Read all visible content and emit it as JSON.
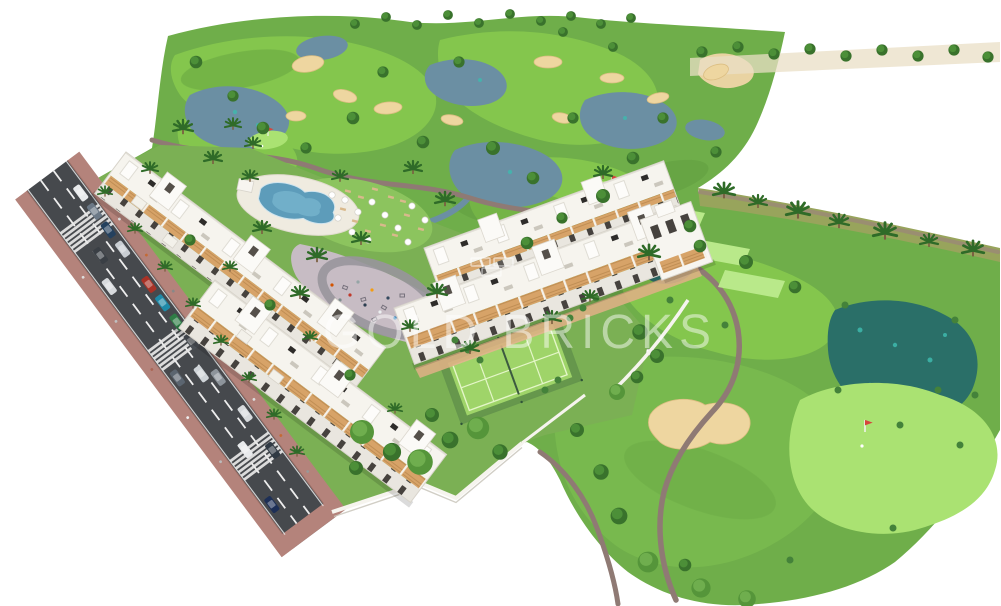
{
  "scene": {
    "type": "architectural-aerial-render",
    "description": "Aerial 3D rendering of a white low-rise apartment resort beside a golf course with lakes, sand bunkers, a lagoon swimming pool, padel court, playground plaza, walled gardens and a tree-lined street with traffic",
    "watermark": {
      "text": "GOLD BRICKS"
    }
  },
  "palette": {
    "background": "#ffffff",
    "golf_base_green": "#6fae4a",
    "fairway_green": "#84c64d",
    "putting_green": "#aae272",
    "tee_green": "#b9e98a",
    "site_lawn_green": "#7bb054",
    "lake_blue": "#6b8fa3",
    "wetland_teal": "#2a6f68",
    "pool_blue": "#5d9cba",
    "sand_bunker": "#eed6a0",
    "cart_path_brown": "#8f7a74",
    "asphalt_gray": "#46494d",
    "sidewalk_brick": "#b4837b",
    "building_white": "#f7f5f0",
    "terrace_wood": "#d7a368",
    "padel_court_green": "#9fd469",
    "plaza_paving": "#c7bcc4",
    "tree_green": "#39722c",
    "flag_red": "#d6453c"
  },
  "inventory": {
    "apartment_rows": 4,
    "street_cars": 17,
    "crosswalks": 3,
    "lakes": 6,
    "sand_bunkers": 11,
    "golf_flags": 3,
    "tee_boxes": 3,
    "swimming_pools": 1,
    "padel_courts": 1,
    "playgrounds": 1
  }
}
